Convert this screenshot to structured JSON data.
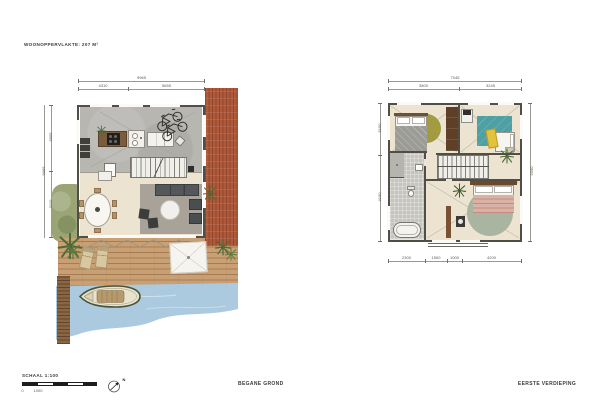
{
  "page": {
    "title": "WOONOPPERVLAKTE: 207 M²",
    "captions": {
      "ground": "BEGANE GROND",
      "first": "EERSTE VERDIEPING"
    },
    "scale": {
      "label": "SCHAAL 1:100",
      "tick_start": "0",
      "tick_mid": "1000"
    },
    "north_label": "N",
    "colors": {
      "paper": "#ffffff",
      "brick_terrace": "#b0593a",
      "water": "#abcadf",
      "deck_wood": "#c99f74",
      "concrete_floor": "#b7b6b1",
      "cream_floor": "#ece4d1",
      "teal_rug": "#4fa0a5",
      "olive_rug": "#a39b42",
      "sage_rug": "#a9b4a1",
      "grass": "#9aa474",
      "wall": "#514e48"
    }
  },
  "ground_floor": {
    "dims": {
      "top_total": "9965",
      "top_segments": [
        "4310",
        "5655"
      ],
      "left_total": "9065",
      "left_segments": [
        "5955",
        "3110"
      ]
    }
  },
  "first_floor": {
    "dims": {
      "top_total": "7045",
      "top_segments": [
        "3800",
        "3245"
      ],
      "bottom_segments": [
        "2300",
        "1500",
        "1000",
        "4200"
      ],
      "right_total": "9340",
      "left_segments": [
        "5150",
        "4190"
      ]
    }
  }
}
